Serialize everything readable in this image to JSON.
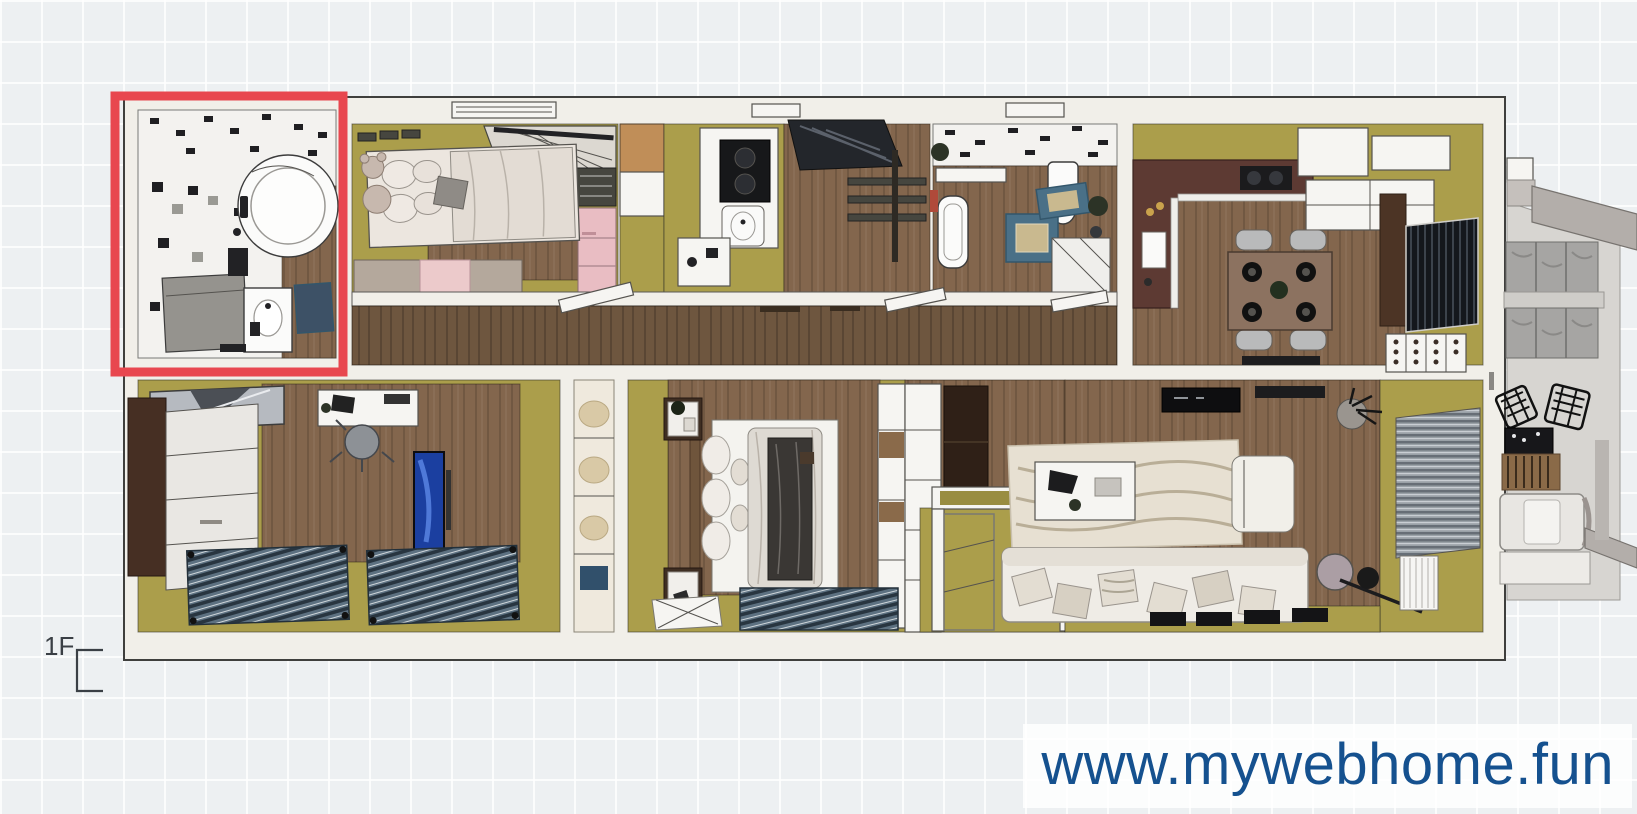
{
  "app": {
    "view": "floor-plan-top-view"
  },
  "floor_selector": {
    "label": "1F"
  },
  "watermark": {
    "text": "www.mywebhome.fun",
    "color": "#15518f"
  },
  "highlight": {
    "target_room": "bathroom-main",
    "color": "#e8474f"
  },
  "rooms": [
    {
      "id": "bathroom-main",
      "highlighted": true
    },
    {
      "id": "kids-bedroom",
      "highlighted": false
    },
    {
      "id": "pantry",
      "highlighted": false
    },
    {
      "id": "kitchen",
      "highlighted": false
    },
    {
      "id": "staircase",
      "highlighted": false
    },
    {
      "id": "bathroom-2",
      "highlighted": false
    },
    {
      "id": "dining-kitchen",
      "highlighted": false
    },
    {
      "id": "corridor",
      "highlighted": false
    },
    {
      "id": "bedroom-left",
      "highlighted": false
    },
    {
      "id": "closet",
      "highlighted": false
    },
    {
      "id": "master-bedroom",
      "highlighted": false
    },
    {
      "id": "entry-hall",
      "highlighted": false
    },
    {
      "id": "living-room",
      "highlighted": false
    },
    {
      "id": "balcony",
      "highlighted": false
    }
  ],
  "palette": {
    "bg": "#edf0f2",
    "wall": "#f1efe9",
    "outline": "#3f3f3d",
    "olive": "#ab9e4b",
    "oliveDark": "#998d41",
    "wood": "#83664d",
    "woodDark": "#6e563f",
    "woodLight": "#c08e58",
    "tile": "#f3f2ef",
    "pink": "#e9bdc3",
    "beige": "#b4a89c",
    "maroon": "#5d3a33",
    "blueRug": "#4a7087",
    "matBlue": "#3d5166",
    "navy": "#1b3fa0",
    "concrete": "#d7d5d1",
    "beam": "#b3aeaa",
    "red": "#e8474f",
    "watermark": "#15518f",
    "label": "#3a3f45"
  }
}
